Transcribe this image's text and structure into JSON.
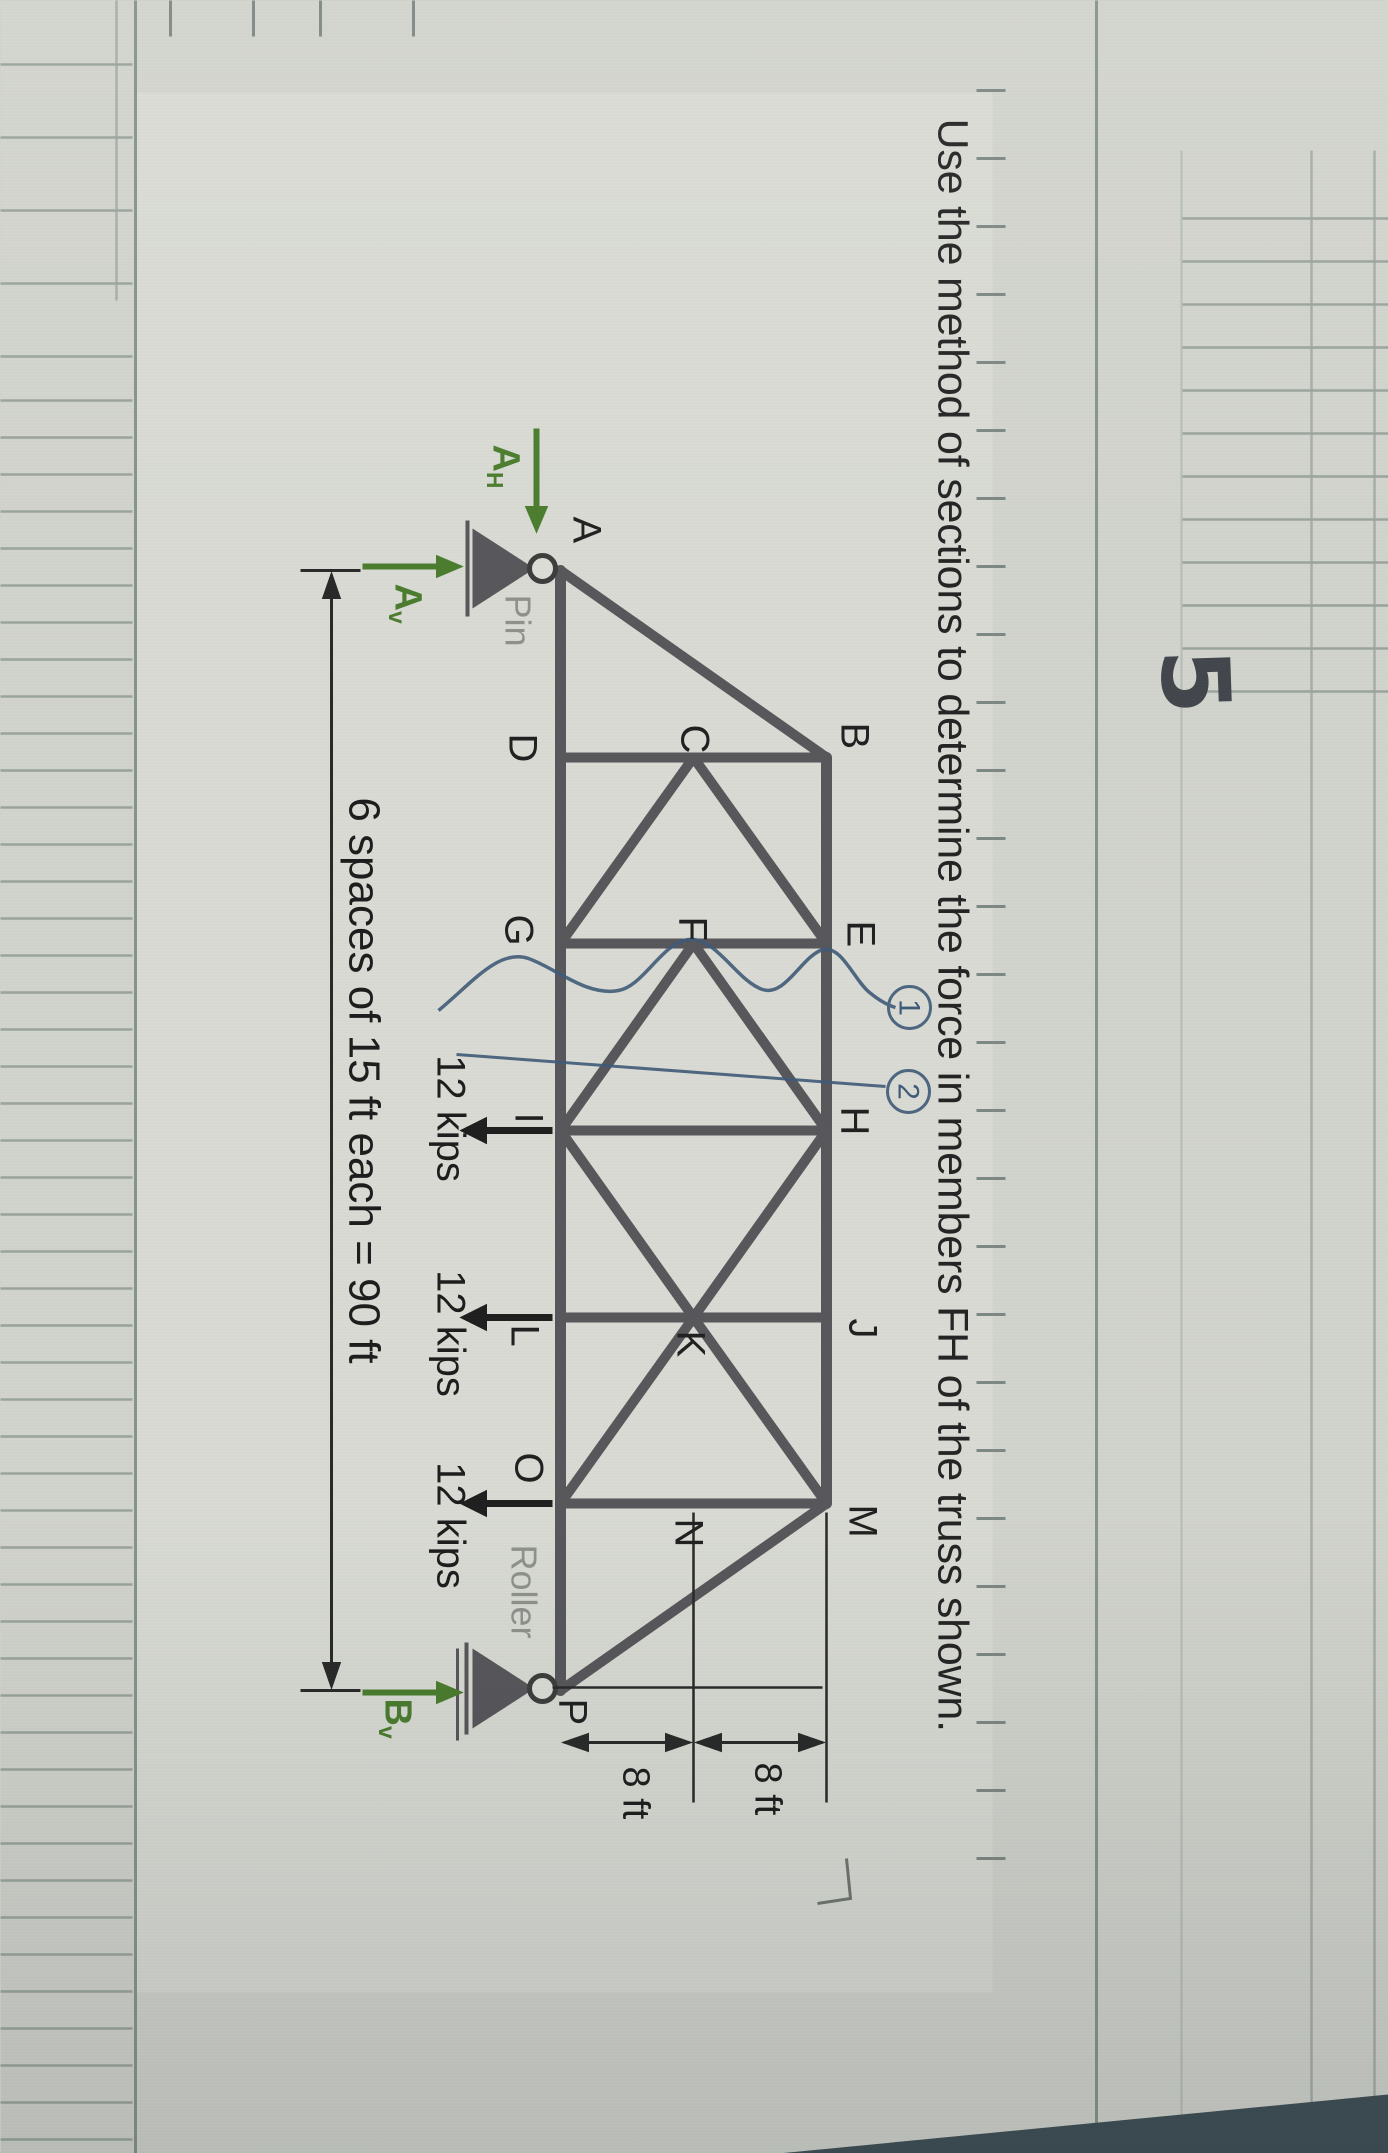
{
  "problem": {
    "number": "5",
    "statement": "Use the method of sections to determine the force in members FH of the truss shown."
  },
  "truss": {
    "node_labels": {
      "A": "A",
      "B": "B",
      "C": "C",
      "D": "D",
      "E": "E",
      "F": "F",
      "G": "G",
      "H": "H",
      "I": "I",
      "J": "J",
      "K": "K",
      "L": "L",
      "M": "M",
      "N": "N",
      "O": "O",
      "P": "P"
    },
    "support_labels": {
      "pin": "Pin",
      "roller": "Roller"
    },
    "loads": {
      "at_I": "12 kips",
      "at_L": "12 kips",
      "at_O": "12 kips"
    },
    "dimensions": {
      "span": "6 spaces of 15 ft each = 90 ft",
      "height_upper": "8 ft",
      "height_lower": "8 ft"
    },
    "reactions": {
      "ah": {
        "base": "A",
        "sub": "H"
      },
      "av": {
        "base": "A",
        "sub": "v"
      },
      "bv": {
        "base": "B",
        "sub": "v"
      }
    },
    "annotations": {
      "section1": "1",
      "section2": "2"
    }
  }
}
